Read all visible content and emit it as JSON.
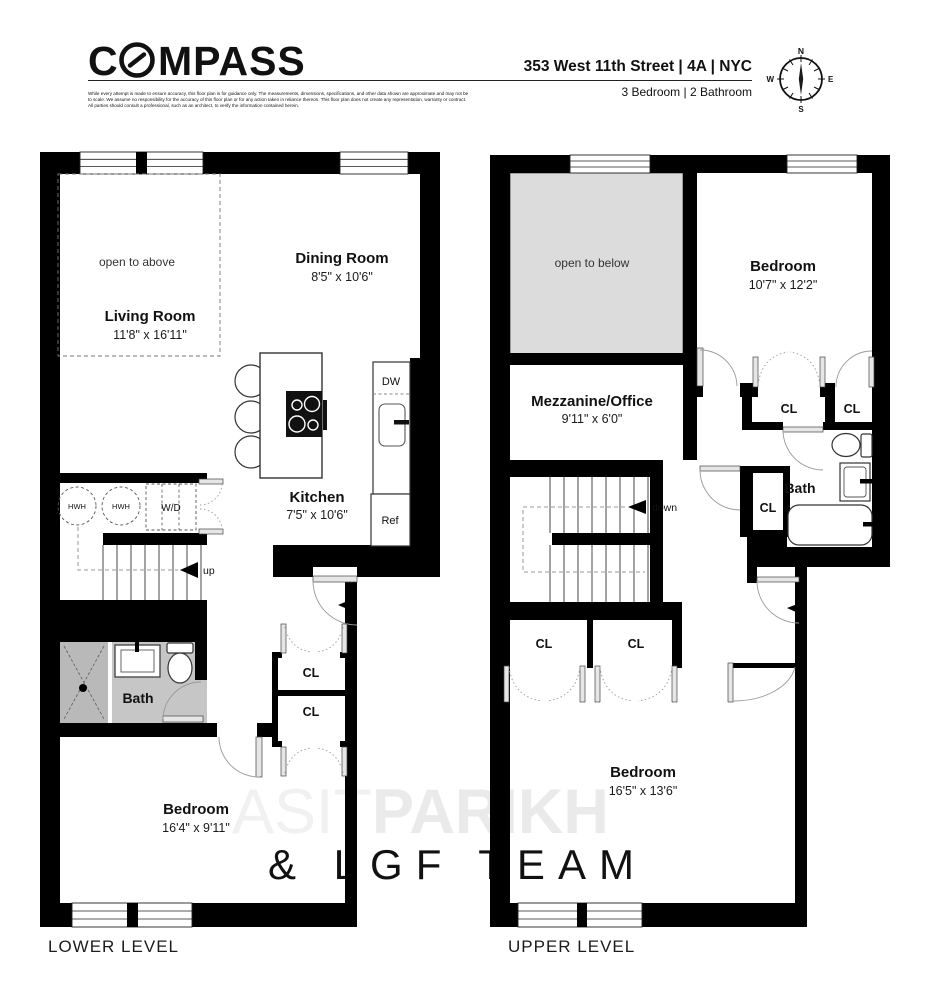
{
  "header": {
    "logo_prefix": "C",
    "logo_suffix": "MPASS",
    "address": "353 West 11th Street | 4A | NYC",
    "unit_info": "3 Bedroom | 2 Bathroom",
    "disclaimer": [
      "While every attempt is made to ensure accuracy, this floor plan is for guidance only. The measurements, dimensions, specifications, and other data shown are approximate and may not be",
      "to scale. We assume no responsibility for the accuracy of this floor plan or for any action taken in reliance thereon. This floor plan does not create any representation, warranty or contract.",
      "All parties should consult a professional, such as an architect, to verify the information contained herein."
    ],
    "compass": {
      "n": "N",
      "e": "E",
      "s": "S",
      "w": "W",
      "north_color": "#c23524"
    }
  },
  "watermark": {
    "thin": "ASIT",
    "bold": "PARIKH",
    "line2": "& LGF TEAM"
  },
  "lower": {
    "level_label": "LOWER LEVEL",
    "open_note": "open to above",
    "living": {
      "name": "Living Room",
      "dims": "11'8\" x 16'11\""
    },
    "dining": {
      "name": "Dining Room",
      "dims": "8'5\" x 10'6\""
    },
    "kitchen": {
      "name": "Kitchen",
      "dims": "7'5\" x 10'6\""
    },
    "bedroom": {
      "name": "Bedroom",
      "dims": "16'4\" x 9'11\""
    },
    "bath": "Bath",
    "hwh1": "HWH",
    "hwh2": "HWH",
    "wd": "W/D",
    "dw": "DW",
    "ref": "Ref",
    "up": "up",
    "cl1": "CL",
    "cl2": "CL"
  },
  "upper": {
    "level_label": "UPPER LEVEL",
    "open_note": "open to below",
    "bedroom1": {
      "name": "Bedroom",
      "dims": "10'7\" x 12'2\""
    },
    "mezzanine": {
      "name": "Mezzanine/Office",
      "dims": "9'11\" x 6'0\""
    },
    "bedroom2": {
      "name": "Bedroom",
      "dims": "16'5\" x 13'6\""
    },
    "bath": "Bath",
    "down": "down",
    "cl1": "CL",
    "cl2": "CL",
    "cl3": "CL",
    "cl4": "CL",
    "cl5": "CL"
  }
}
